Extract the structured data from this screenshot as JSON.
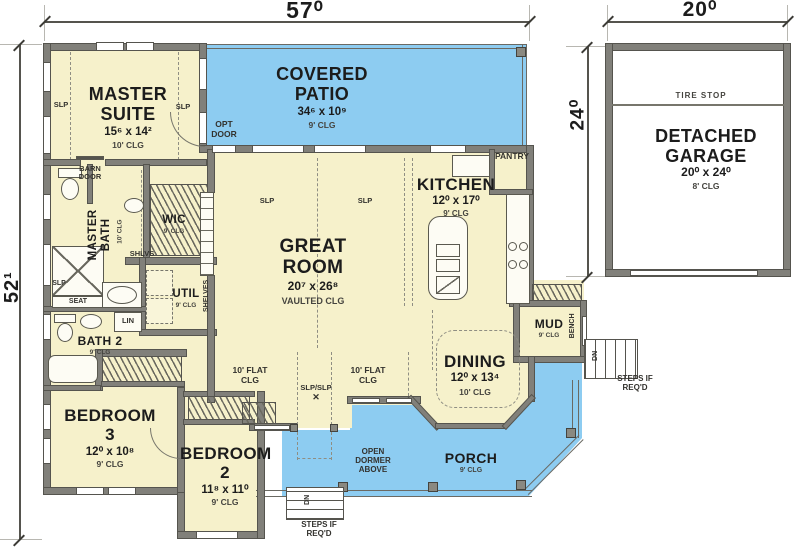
{
  "dims": {
    "house_width": "57⁰",
    "house_depth": "52¹",
    "garage_width": "20⁰",
    "garage_depth": "24⁰"
  },
  "rooms": {
    "master_suite": {
      "name": "MASTER\nSUITE",
      "size": "15⁶ x 14²",
      "clg": "10' CLG"
    },
    "covered_patio": {
      "name": "COVERED\nPATIO",
      "size": "34⁶ x 10⁹",
      "clg": "9' CLG"
    },
    "kitchen": {
      "name": "KITCHEN",
      "size": "12⁰ x 17⁰",
      "clg": "9' CLG"
    },
    "great_room": {
      "name": "GREAT\nROOM",
      "size": "20⁷ x 26⁸",
      "clg": "VAULTED CLG"
    },
    "dining": {
      "name": "DINING",
      "size": "12⁰ x 13⁴",
      "clg": "10' CLG"
    },
    "master_bath": {
      "name": "MASTER\nBATH",
      "clg": "10' CLG"
    },
    "wic": {
      "name": "WIC",
      "clg": "9' CLG"
    },
    "util": {
      "name": "UTIL",
      "clg": "9' CLG"
    },
    "bath2": {
      "name": "BATH 2",
      "clg": "9' CLG"
    },
    "bedroom3": {
      "name": "BEDROOM\n3",
      "size": "12⁰ x 10⁸",
      "clg": "9' CLG"
    },
    "bedroom2": {
      "name": "BEDROOM\n2",
      "size": "11⁸ x 11⁰",
      "clg": "9' CLG"
    },
    "mud": {
      "name": "MUD",
      "clg": "9' CLG"
    },
    "porch": {
      "name": "PORCH",
      "clg": "9' CLG"
    },
    "garage": {
      "name": "DETACHED\nGARAGE",
      "size": "20⁰ x 24⁰",
      "clg": "8' CLG"
    }
  },
  "labels": {
    "tire_stop": "TIRE  STOP",
    "pantry": "PANTRY",
    "opt_door": "OPT\nDOOR",
    "barn_door": "BARN\nDOOR",
    "shlvs": "SHLVS",
    "shelves": "SHELVES",
    "seat": "SEAT",
    "lin": "LIN",
    "bench": "BENCH",
    "flat_clg": "10' FLAT\nCLG",
    "slp": "SLP",
    "slp_slp": "SLP/SLP",
    "x_mark": "✕",
    "open_dormer": "OPEN\nDORMER\nABOVE",
    "dn": "DN",
    "steps_if_reqd": "STEPS IF\nREQ'D"
  },
  "colors": {
    "floor": "#f6f1cb",
    "outdoor": "#8dccf1",
    "wall": "#81807a",
    "line": "#55544e"
  }
}
